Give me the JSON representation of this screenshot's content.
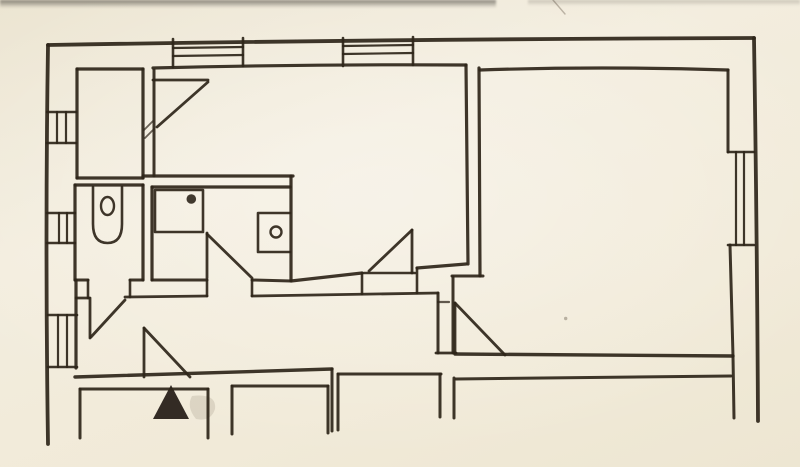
{
  "canvas": {
    "width": 800,
    "height": 467
  },
  "style": {
    "paper_color": "#f1ead9",
    "ink_color": "#2e2519",
    "soft_ink_color": "#8d8172"
  },
  "floorplan": {
    "kind": "hand-drawn floor plan sketch",
    "strokes": [
      {
        "n": "outer-wall-top",
        "d": "M48,45 Q400,39 754,38",
        "w": 3.8
      },
      {
        "n": "outer-wall-left",
        "d": "M48,45 Q45,240 48,444",
        "w": 3.8
      },
      {
        "n": "outer-wall-right",
        "d": "M754,38 Q757,230 758,421",
        "w": 3.8
      },
      {
        "n": "hall-room-top",
        "d": "M77,69 L143,69",
        "w": 3.2
      },
      {
        "n": "hall-room-left",
        "d": "M77,69 L77,178",
        "w": 3.2
      },
      {
        "n": "hall-room-bottom",
        "d": "M77,178 L143,178",
        "w": 3.2
      },
      {
        "n": "hall-room-right",
        "d": "M143,69 L143,178",
        "w": 3.2
      },
      {
        "n": "living-room-top",
        "d": "M153,68 Q310,64 466,65",
        "w": 3.2
      },
      {
        "n": "living-room-left",
        "d": "M154,70 L154,176",
        "w": 3
      },
      {
        "n": "wall-hatch-1",
        "d": "M144,130 L153,121",
        "w": 1.8,
        "o": 0.7
      },
      {
        "n": "wall-hatch-2",
        "d": "M145,138 L154,129",
        "w": 1.8,
        "o": 0.7
      },
      {
        "n": "mid-wall-upper",
        "d": "M143,176 L293,176",
        "w": 3.2
      },
      {
        "n": "wc-top",
        "d": "M75,185 L143,185",
        "w": 3.2
      },
      {
        "n": "wc-left",
        "d": "M75,185 L75,280",
        "w": 3.2
      },
      {
        "n": "wc-right",
        "d": "M143,185 L143,280",
        "w": 3.2
      },
      {
        "n": "wc-bottom-left-seg",
        "d": "M75,280 L88,280",
        "w": 3
      },
      {
        "n": "wc-bottom-right-seg",
        "d": "M130,280 L143,280",
        "w": 3
      },
      {
        "n": "bathroom-top",
        "d": "M152,187 L290,187",
        "w": 3.2
      },
      {
        "n": "bathroom-left",
        "d": "M152,187 L152,280",
        "w": 3.2
      },
      {
        "n": "bathroom-right",
        "d": "M291,176 L291,280",
        "w": 3.2
      },
      {
        "n": "bathroom-bottom-left-seg",
        "d": "M152,280 L207,280",
        "w": 3
      },
      {
        "n": "bathroom-bottom-right-seg",
        "d": "M252,280 L291,281",
        "w": 3
      },
      {
        "n": "living-room-bottom-west",
        "d": "M291,281 L362,273",
        "w": 3.2
      },
      {
        "n": "living-room-bottom-east",
        "d": "M417,268 L466,264",
        "w": 3.2
      },
      {
        "n": "living-room-right",
        "d": "M466,65 L468,264",
        "w": 3.2
      },
      {
        "n": "big-room-left",
        "d": "M479,68 L480,276",
        "w": 3.2
      },
      {
        "n": "corridor-top-seg1",
        "d": "M76,298 L89,298",
        "w": 2.8
      },
      {
        "n": "corridor-top-seg2",
        "d": "M125,297 L207,296",
        "w": 2.8
      },
      {
        "n": "corridor-top-seg3",
        "d": "M252,296 L438,293",
        "w": 2.8
      },
      {
        "n": "jamb-wc-left",
        "d": "M88,280 L88,298",
        "w": 2.6
      },
      {
        "n": "jamb-wc-right",
        "d": "M130,280 L130,297",
        "w": 2.6
      },
      {
        "n": "jamb-bath-left",
        "d": "M207,280 L207,296",
        "w": 2.6
      },
      {
        "n": "jamb-bath-right",
        "d": "M252,280 L252,296",
        "w": 2.6
      },
      {
        "n": "jamb-living-left",
        "d": "M362,273 L362,294",
        "w": 2.6
      },
      {
        "n": "jamb-living-right",
        "d": "M417,268 L417,293",
        "w": 2.6
      },
      {
        "n": "corridor-left",
        "d": "M76,280 L76,368",
        "w": 3.2
      },
      {
        "n": "corridor-bottom",
        "d": "M75,377 Q200,373 332,369",
        "w": 3.4
      },
      {
        "n": "corridor-right-inner",
        "d": "M438,293 L438,353",
        "w": 3
      },
      {
        "n": "corridor-right-outer",
        "d": "M453,277 L453,353",
        "w": 3
      },
      {
        "n": "corridor-right-cap",
        "d": "M436,353 L456,353",
        "w": 2.8
      },
      {
        "n": "big-room-jog",
        "d": "M452,276 L483,276",
        "w": 3
      },
      {
        "n": "corridor-stub",
        "d": "M438,302 L449,302",
        "w": 2.2,
        "o": 0.75
      },
      {
        "n": "big-room-top",
        "d": "M480,70 Q600,66 728,70",
        "w": 3.2
      },
      {
        "n": "big-room-right-upper",
        "d": "M728,70 L728,152",
        "w": 3
      },
      {
        "n": "big-room-right-lower",
        "d": "M730,245 L733,356",
        "w": 3
      },
      {
        "n": "big-room-bottom",
        "d": "M455,354 L733,356",
        "w": 3.4
      },
      {
        "n": "terrace-edge",
        "d": "M456,379 L731,376",
        "w": 3
      },
      {
        "n": "terrace-right-wall",
        "d": "M733,356 L734,418",
        "w": 3
      },
      {
        "n": "terrace-left-wall",
        "d": "M454,378 L454,418",
        "w": 3
      },
      {
        "n": "porch-c-right-wall",
        "d": "M440,374 L440,417",
        "w": 3
      },
      {
        "n": "porch-c-top",
        "d": "M338,374 L441,374",
        "w": 3
      },
      {
        "n": "porch-c-left-wall",
        "d": "M338,374 L338,430",
        "w": 3
      },
      {
        "n": "corridor-corner-drop",
        "d": "M332,369 L332,431",
        "w": 3
      },
      {
        "n": "porch-a-left-wall",
        "d": "M80,389 L80,438",
        "w": 3
      },
      {
        "n": "porch-a-top",
        "d": "M80,389 L208,389",
        "w": 3
      },
      {
        "n": "porch-a-right-wall",
        "d": "M208,389 L208,438",
        "w": 3
      },
      {
        "n": "porch-b-left-wall",
        "d": "M232,386 L232,434",
        "w": 3
      },
      {
        "n": "porch-b-top",
        "d": "M232,386 L328,386",
        "w": 3
      },
      {
        "n": "porch-b-right-wall",
        "d": "M328,386 L328,433",
        "w": 3
      },
      {
        "n": "window-top-1-cap-left",
        "d": "M173,39 L173,67",
        "w": 2.6
      },
      {
        "n": "window-top-1-cap-right",
        "d": "M243,38 L243,66",
        "w": 2.6
      },
      {
        "n": "window-top-1-pane-1",
        "d": "M173,48 L243,47",
        "w": 2.2
      },
      {
        "n": "window-top-1-pane-2",
        "d": "M173,56 L243,55",
        "w": 2.2
      },
      {
        "n": "window-top-2-cap-left",
        "d": "M343,38 L343,66",
        "w": 2.6
      },
      {
        "n": "window-top-2-cap-right",
        "d": "M413,37 L413,65",
        "w": 2.6
      },
      {
        "n": "window-top-2-pane-1",
        "d": "M343,46 L413,45",
        "w": 2.2
      },
      {
        "n": "window-top-2-pane-2",
        "d": "M343,54 L413,53",
        "w": 2.2
      },
      {
        "n": "window-left-1-cap-top",
        "d": "M47,112 L76,112",
        "w": 2.6
      },
      {
        "n": "window-left-1-cap-bottom",
        "d": "M47,143 L76,143",
        "w": 2.6
      },
      {
        "n": "window-left-1-pane-1",
        "d": "M57,112 L57,143",
        "w": 2.2
      },
      {
        "n": "window-left-1-pane-2",
        "d": "M66,112 L66,143",
        "w": 2.2
      },
      {
        "n": "window-left-2-cap-top",
        "d": "M47,213 L75,213",
        "w": 2.6
      },
      {
        "n": "window-left-2-cap-bottom",
        "d": "M47,243 L75,243",
        "w": 2.6
      },
      {
        "n": "window-left-2-pane-1",
        "d": "M59,213 L59,243",
        "w": 2.2
      },
      {
        "n": "window-left-2-pane-2",
        "d": "M67,213 L67,243",
        "w": 2.2
      },
      {
        "n": "window-left-3-cap-top",
        "d": "M48,315 L77,315",
        "w": 2.6
      },
      {
        "n": "window-left-3-cap-bottom",
        "d": "M48,367 L77,367",
        "w": 2.6
      },
      {
        "n": "window-left-3-pane-1",
        "d": "M58,315 L58,367",
        "w": 2.2
      },
      {
        "n": "window-left-3-pane-2",
        "d": "M67,315 L67,367",
        "w": 2.2
      },
      {
        "n": "window-right-cap-top",
        "d": "M728,152 L754,152",
        "w": 2.6
      },
      {
        "n": "window-right-cap-bottom",
        "d": "M728,245 L754,245",
        "w": 2.6
      },
      {
        "n": "window-right-pane-1",
        "d": "M736,152 L736,245",
        "w": 2.2
      },
      {
        "n": "window-right-pane-2",
        "d": "M744,152 L744,245",
        "w": 2.2
      },
      {
        "n": "door-hall-leaf",
        "d": "M153,80 L208,80",
        "w": 2.8
      },
      {
        "n": "door-hall-swing",
        "d": "M208,82 L157,127",
        "w": 2.8
      },
      {
        "n": "door-wc-leaf",
        "d": "M90,298 L90,338",
        "w": 2.8
      },
      {
        "n": "door-wc-swing",
        "d": "M125,300 L91,337",
        "w": 2.8
      },
      {
        "n": "door-bath-leaf",
        "d": "M207,233 L207,278",
        "w": 2.8
      },
      {
        "n": "door-bath-swing",
        "d": "M207,234 L252,278",
        "w": 2.8
      },
      {
        "n": "door-living-leaf",
        "d": "M412,230 L412,273",
        "w": 2.8
      },
      {
        "n": "door-living-swing",
        "d": "M412,230 L369,271",
        "w": 2.8
      },
      {
        "n": "door-living-base",
        "d": "M364,273 L415,273",
        "w": 2.6
      },
      {
        "n": "door-entry-leaf",
        "d": "M144,328 L144,377",
        "w": 2.8
      },
      {
        "n": "door-entry-swing",
        "d": "M144,328 L190,377",
        "w": 2.8
      },
      {
        "n": "door-big-room-leaf",
        "d": "M455,303 L455,353",
        "w": 2.8
      },
      {
        "n": "door-big-room-swing",
        "d": "M455,303 L505,355",
        "w": 2.8
      },
      {
        "n": "toilet-bowl",
        "d": "M93,187 L93,224 Q93,243 107.5,243 Q122,243 122,224 L122,187",
        "w": 2.6
      },
      {
        "n": "toilet-drain",
        "d": "M101,206 a6.5,9 0 1,0 13,0 a6.5,9 0 1,0 -13,0",
        "w": 2.4
      },
      {
        "n": "sink-outline",
        "d": "M155,190 L203,190 L203,232 L155,232 Z",
        "w": 2.6
      },
      {
        "n": "appliance-outline",
        "d": "M290,213 L258,213 L258,252 L290,252",
        "w": 2.6
      },
      {
        "n": "appliance-knob",
        "d": "M270.5,232 a5.5,5.5 0 1,0 11,0 a5.5,5.5 0 1,0 -11,0",
        "w": 2.4
      },
      {
        "n": "paper-scratch",
        "d": "M553,0 L565,14",
        "w": 1.4,
        "c": "#8d8172",
        "o": 0.55
      }
    ],
    "fills": [
      {
        "n": "entrance-arrow",
        "d": "M171,385 L153,419 L189,419 Z",
        "c": "#28211a",
        "o": 0.95
      },
      {
        "n": "entrance-smudge",
        "d": "M192,396 Q217,393 215,409 Q211,422 196,419 Q186,407 192,396 Z",
        "c": "#6b5f4c",
        "o": 0.16
      },
      {
        "n": "sink-faucet-dot",
        "d": "M186.5,199 a4.8,4.8 0 1,0 9.6,0 a4.8,4.8 0 1,0 -9.6,0",
        "c": "#2e2519",
        "o": 0.9
      },
      {
        "n": "paper-speck",
        "d": "M564,318.5 a1.7,1.7 0 1,0 3.4,0 a1.7,1.7 0 1,0 -3.4,0",
        "c": "#5f5646",
        "o": 0.4
      }
    ]
  }
}
